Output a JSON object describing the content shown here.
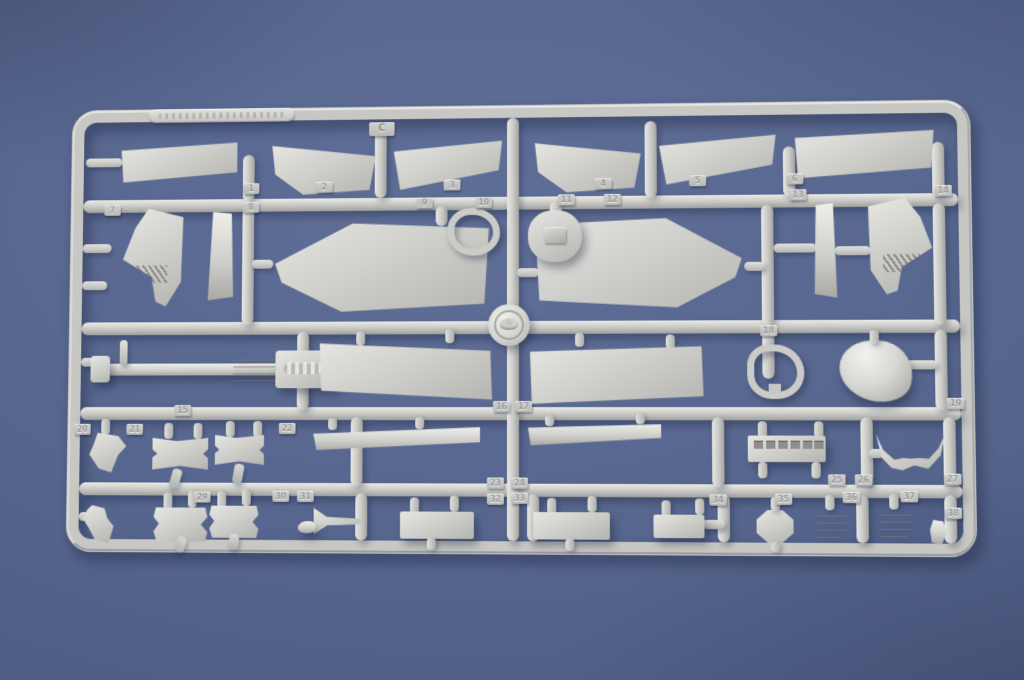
{
  "scene": {
    "type": "photograph",
    "subject": "Light-grey injection-moulded plastic model sprue (parts runner) with aircraft kit parts",
    "backdrop": "plain blue surface",
    "colors": {
      "background": "#55648c",
      "plastic": "#c9c9c5",
      "cast_shadow": "#3e4c70"
    }
  },
  "sprue": {
    "runner_letter": "C",
    "brand_plate": "embossed manufacturer plate (text not legible)",
    "logo_medallion": "round embossed logo at rail junction",
    "part_tabs": [
      {
        "label": "C",
        "x": 312,
        "y": 26,
        "letter": true
      },
      {
        "label": "1",
        "x": 183,
        "y": 87
      },
      {
        "label": "2",
        "x": 258,
        "y": 86
      },
      {
        "label": "3",
        "x": 388,
        "y": 85
      },
      {
        "label": "4",
        "x": 540,
        "y": 85
      },
      {
        "label": "5",
        "x": 634,
        "y": 83
      },
      {
        "label": "6",
        "x": 730,
        "y": 82
      },
      {
        "label": "7",
        "x": 40,
        "y": 108
      },
      {
        "label": "8",
        "x": 183,
        "y": 106
      },
      {
        "label": "9",
        "x": 360,
        "y": 103
      },
      {
        "label": "10",
        "x": 420,
        "y": 103
      },
      {
        "label": "11",
        "x": 503,
        "y": 101
      },
      {
        "label": "12",
        "x": 549,
        "y": 101
      },
      {
        "label": "13",
        "x": 733,
        "y": 98
      },
      {
        "label": "14",
        "x": 875,
        "y": 95
      },
      {
        "label": "18",
        "x": 703,
        "y": 233
      },
      {
        "label": "15",
        "x": 115,
        "y": 312
      },
      {
        "label": "16",
        "x": 438,
        "y": 308
      },
      {
        "label": "17",
        "x": 460,
        "y": 308
      },
      {
        "label": "19",
        "x": 884,
        "y": 305
      },
      {
        "label": "20",
        "x": 12,
        "y": 331
      },
      {
        "label": "21",
        "x": 66,
        "y": 331
      },
      {
        "label": "22",
        "x": 222,
        "y": 330
      },
      {
        "label": "23",
        "x": 432,
        "y": 384
      },
      {
        "label": "24",
        "x": 456,
        "y": 384
      },
      {
        "label": "25",
        "x": 768,
        "y": 380
      },
      {
        "label": "26",
        "x": 794,
        "y": 380
      },
      {
        "label": "27",
        "x": 880,
        "y": 379
      },
      {
        "label": "29",
        "x": 136,
        "y": 399
      },
      {
        "label": "30",
        "x": 216,
        "y": 398
      },
      {
        "label": "31",
        "x": 241,
        "y": 398
      },
      {
        "label": "32",
        "x": 432,
        "y": 400
      },
      {
        "label": "33",
        "x": 456,
        "y": 399
      },
      {
        "label": "34",
        "x": 652,
        "y": 400
      },
      {
        "label": "35",
        "x": 716,
        "y": 399
      },
      {
        "label": "36",
        "x": 782,
        "y": 397
      },
      {
        "label": "37",
        "x": 838,
        "y": 396
      },
      {
        "label": "38",
        "x": 880,
        "y": 412
      }
    ]
  }
}
